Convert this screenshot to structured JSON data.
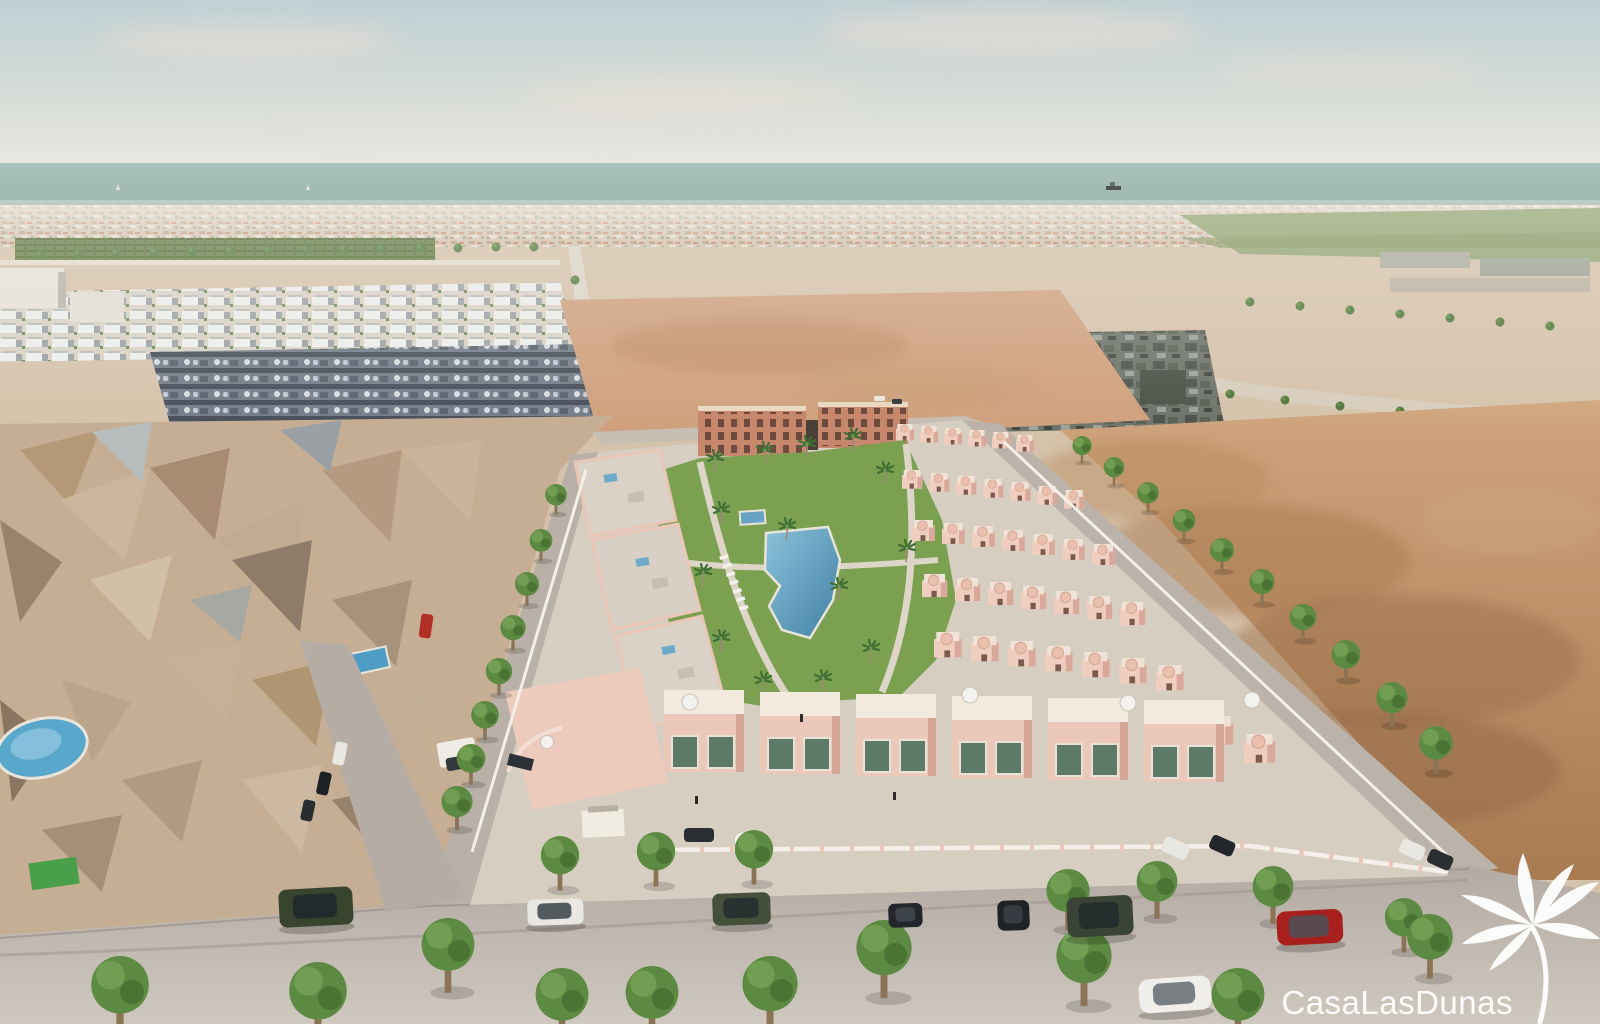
{
  "watermark": {
    "text": "CasaLasDunas",
    "color": "#ffffff",
    "icon": "palm-tree"
  },
  "scene": {
    "type": "aerial-3d-architectural-render",
    "subject": "Aerial render of a new-build pink townhouse development with communal pool and gardens near the coast, surrounded by existing neighborhoods and empty dirt plots",
    "landmarks": [
      "hazy sky",
      "sea horizon with ship",
      "coastal town strip",
      "orchard field",
      "tree-lined roads",
      "white villa rows",
      "dark villa clusters",
      "low-poly existing neighborhood",
      "apartment blocks",
      "playground",
      "communal pool park with palms and sun loungers",
      "rows of townhouses with roof terraces",
      "perimeter white walls",
      "streets with parked cars",
      "street trees"
    ]
  },
  "palette": {
    "sky": "#c3d3d6",
    "haze": "#efede8",
    "sea": "#a4beb6",
    "distant_town": "#cdbba6",
    "sand": "#d5c2aa",
    "dirt": "#b9885f",
    "orchard": "#5f7a44",
    "field_green": "#8da06b",
    "road": "#b8b0a8",
    "paving": "#d7cec2",
    "building_pink": "#ebc8ba",
    "building_shadow": "#d5a494",
    "terracotta": "#c6876c",
    "roof_deck": "#dbd2c7",
    "glass_green": "#5d7a66",
    "pool": "#4f8fb4",
    "lawn": "#7aa050",
    "tree": "#5d8a42",
    "white_wall": "#f4f0e9",
    "car_red": "#a8201d",
    "car_green": "#3a4434",
    "watermark": "#ffffff"
  }
}
